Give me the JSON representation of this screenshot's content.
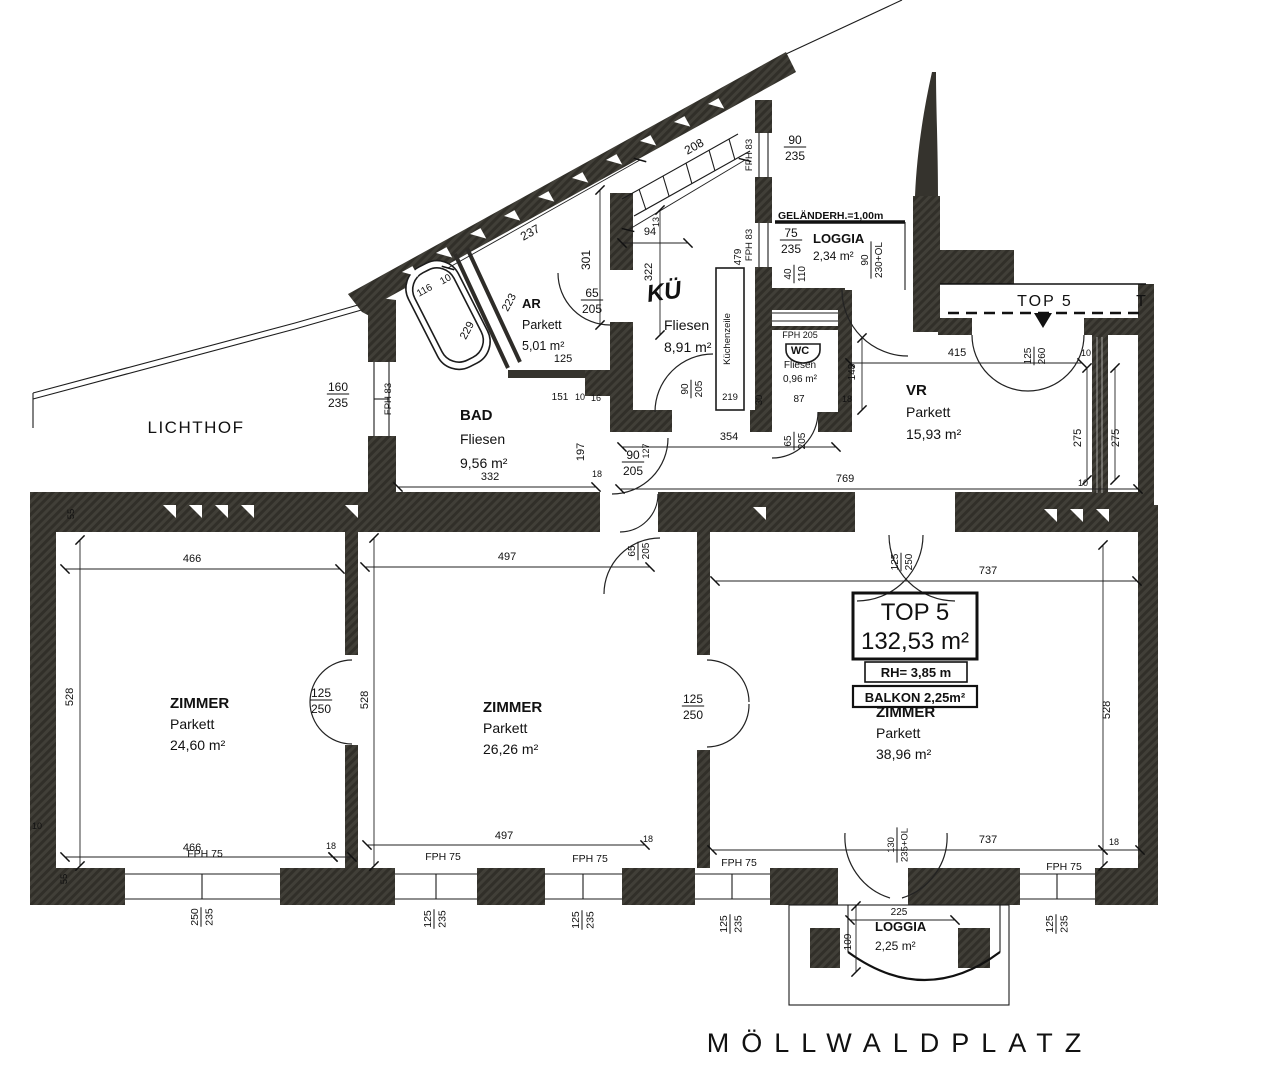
{
  "plan": {
    "street": "MÖLLWALDPLATZ",
    "courtyard": "LICHTHOF",
    "railing_note": "GELÄNDERH.=1,00m",
    "stairwell_strip": {
      "label": "TOP 5",
      "partial_label": "T"
    },
    "title_box": {
      "name": "TOP 5",
      "area": "132,53 m²",
      "room_height": "RH= 3,85 m",
      "balcony": "BALKON 2,25m²"
    },
    "rooms": [
      {
        "name": "AR",
        "floor": "Parkett",
        "area": "5,01 m²",
        "x": 522,
        "y": 308,
        "lh": 21,
        "a": "start",
        "ns": 13,
        "s": 12.5
      },
      {
        "name": "BAD",
        "floor": "Fliesen",
        "area": "9,56 m²",
        "x": 460,
        "y": 420,
        "lh": 24,
        "a": "start",
        "ns": 15,
        "s": 14
      },
      {
        "name": "KÜ",
        "floor": "Fliesen",
        "area": "8,91 m²",
        "x": 664,
        "y": 330,
        "lh": 22,
        "a": "start",
        "ns": 15,
        "s": 14,
        "script": 1,
        "nx": 648,
        "ny": 302
      },
      {
        "name": "WC",
        "floor": "Fliesen",
        "area": "0,96 m²",
        "x": 800,
        "y": 354,
        "lh": 14,
        "a": "middle",
        "ns": 11,
        "s": 10
      },
      {
        "name": "VR",
        "floor": "Parkett",
        "area": "15,93 m²",
        "x": 906,
        "y": 395,
        "lh": 22,
        "a": "start",
        "ns": 15,
        "s": 14
      },
      {
        "name": "LOGGIA",
        "floor": "",
        "area": "2,34 m²",
        "x": 813,
        "y": 243,
        "lh": 17,
        "a": "start",
        "ns": 13,
        "s": 12
      },
      {
        "name": "ZIMMER",
        "floor": "Parkett",
        "area": "24,60 m²",
        "x": 170,
        "y": 708,
        "lh": 21,
        "a": "start",
        "ns": 15,
        "s": 14
      },
      {
        "name": "ZIMMER",
        "floor": "Parkett",
        "area": "26,26 m²",
        "x": 483,
        "y": 712,
        "lh": 21,
        "a": "start",
        "ns": 15,
        "s": 14
      },
      {
        "name": "ZIMMER",
        "floor": "Parkett",
        "area": "38,96 m²",
        "x": 876,
        "y": 717,
        "lh": 21,
        "a": "start",
        "ns": 15,
        "s": 14
      },
      {
        "name": "LOGGIA",
        "floor": "",
        "area": "2,25 m²",
        "x": 875,
        "y": 931,
        "lh": 19,
        "a": "start",
        "ns": 13,
        "s": 12
      }
    ],
    "dims": [
      {
        "t": "208",
        "x": 696,
        "y": 150,
        "r": -29
      },
      {
        "t": "FPH 83",
        "x": 752,
        "y": 155,
        "r": -90,
        "s": 9.5
      },
      {
        "t": "90/235",
        "x": 795,
        "y": 147,
        "st": 1
      },
      {
        "t": "75/235",
        "x": 791,
        "y": 240,
        "st": 1
      },
      {
        "t": "40/110",
        "x": 794,
        "y": 274,
        "r": -90,
        "st": 1,
        "s": 10
      },
      {
        "t": "90/230+OL",
        "x": 871,
        "y": 260,
        "r": -90,
        "st": 1,
        "s": 10
      },
      {
        "t": "479",
        "x": 741,
        "y": 257,
        "r": -90,
        "s": 10
      },
      {
        "t": "FPH 83",
        "x": 752,
        "y": 245,
        "r": -90,
        "s": 9.5
      },
      {
        "t": "94",
        "x": 650,
        "y": 235,
        "s": 11
      },
      {
        "t": "13",
        "x": 659,
        "y": 222,
        "r": -90,
        "s": 9
      },
      {
        "t": "322",
        "x": 652,
        "y": 272,
        "r": -90,
        "s": 11
      },
      {
        "t": "237",
        "x": 532,
        "y": 236,
        "r": -29
      },
      {
        "t": "301",
        "x": 590,
        "y": 260,
        "r": -90
      },
      {
        "t": "116",
        "x": 426,
        "y": 293,
        "r": -29,
        "s": 10
      },
      {
        "t": "10",
        "x": 447,
        "y": 282,
        "r": -29,
        "s": 10
      },
      {
        "t": "229",
        "x": 470,
        "y": 332,
        "r": -62,
        "s": 11
      },
      {
        "t": "223",
        "x": 512,
        "y": 304,
        "r": -62,
        "s": 11
      },
      {
        "t": "65/205",
        "x": 592,
        "y": 300,
        "st": 1
      },
      {
        "t": "125",
        "x": 563,
        "y": 362,
        "s": 11
      },
      {
        "t": "151",
        "x": 560,
        "y": 400,
        "s": 10
      },
      {
        "t": "10",
        "x": 580,
        "y": 400,
        "s": 9
      },
      {
        "t": "16",
        "x": 596,
        "y": 401,
        "s": 9
      },
      {
        "t": "160/235",
        "x": 338,
        "y": 394,
        "st": 1
      },
      {
        "t": "FPH 83",
        "x": 391,
        "y": 399,
        "r": -90,
        "s": 9.5
      },
      {
        "t": "332",
        "x": 490,
        "y": 480,
        "s": 11
      },
      {
        "t": "197",
        "x": 584,
        "y": 452,
        "r": -90,
        "s": 11
      },
      {
        "t": "18",
        "x": 597,
        "y": 477,
        "s": 9
      },
      {
        "t": "90/205",
        "x": 633,
        "y": 462,
        "st": 1
      },
      {
        "t": "127",
        "x": 649,
        "y": 451,
        "r": -90,
        "s": 9
      },
      {
        "t": "354",
        "x": 729,
        "y": 440,
        "s": 11
      },
      {
        "t": "65/205",
        "x": 794,
        "y": 441,
        "r": -90,
        "st": 1,
        "s": 10
      },
      {
        "t": "769",
        "x": 845,
        "y": 482,
        "s": 11
      },
      {
        "t": "90/205",
        "x": 691,
        "y": 389,
        "r": -90,
        "st": 1,
        "s": 10
      },
      {
        "t": "219",
        "x": 730,
        "y": 400,
        "s": 9.5
      },
      {
        "t": "30",
        "x": 762,
        "y": 400,
        "r": -90,
        "s": 9.5
      },
      {
        "t": "87",
        "x": 799,
        "y": 402,
        "s": 10
      },
      {
        "t": "18",
        "x": 847,
        "y": 402,
        "s": 9
      },
      {
        "t": "148",
        "x": 855,
        "y": 372,
        "r": -90,
        "s": 10
      },
      {
        "t": "FPH 205",
        "x": 800,
        "y": 338,
        "s": 9
      },
      {
        "t": "415",
        "x": 957,
        "y": 356,
        "s": 11
      },
      {
        "t": "125/260",
        "x": 1034,
        "y": 356,
        "r": -90,
        "st": 1,
        "s": 10
      },
      {
        "t": "10",
        "x": 1086,
        "y": 356,
        "s": 9
      },
      {
        "t": "275",
        "x": 1081,
        "y": 438,
        "r": -90,
        "s": 11
      },
      {
        "t": "275",
        "x": 1119,
        "y": 438,
        "r": -90,
        "s": 11
      },
      {
        "t": "10",
        "x": 1083,
        "y": 486,
        "s": 9
      },
      {
        "t": "Küchenzeile",
        "x": 730,
        "y": 339,
        "r": -90,
        "s": 9.5
      },
      {
        "t": "55",
        "x": 74,
        "y": 514,
        "r": -90,
        "s": 9.5
      },
      {
        "t": "466",
        "x": 192,
        "y": 562,
        "s": 11
      },
      {
        "t": "497",
        "x": 507,
        "y": 560,
        "s": 11
      },
      {
        "t": "737",
        "x": 988,
        "y": 574,
        "s": 11
      },
      {
        "t": "65/205",
        "x": 638,
        "y": 551,
        "r": -90,
        "st": 1,
        "s": 10
      },
      {
        "t": "125/250",
        "x": 901,
        "y": 562,
        "r": -90,
        "st": 1,
        "s": 10
      },
      {
        "t": "528",
        "x": 73,
        "y": 697,
        "r": -90,
        "s": 11
      },
      {
        "t": "528",
        "x": 368,
        "y": 700,
        "r": -90,
        "s": 11
      },
      {
        "t": "528",
        "x": 1110,
        "y": 710,
        "r": -90,
        "s": 11
      },
      {
        "t": "125/250",
        "x": 321,
        "y": 700,
        "st": 1
      },
      {
        "t": "125/250",
        "x": 693,
        "y": 706,
        "st": 1
      },
      {
        "t": "466",
        "x": 192,
        "y": 851,
        "s": 11
      },
      {
        "t": "18",
        "x": 331,
        "y": 849,
        "s": 9
      },
      {
        "t": "497",
        "x": 504,
        "y": 839,
        "s": 11
      },
      {
        "t": "18",
        "x": 648,
        "y": 842,
        "s": 9
      },
      {
        "t": "737",
        "x": 988,
        "y": 843,
        "s": 11
      },
      {
        "t": "18",
        "x": 1114,
        "y": 845,
        "s": 9
      },
      {
        "t": "10",
        "x": 37,
        "y": 829,
        "s": 9
      },
      {
        "t": "55",
        "x": 67,
        "y": 879,
        "r": -90,
        "s": 9.5
      },
      {
        "t": "FPH 75",
        "x": 205,
        "y": 857,
        "s": 10.5
      },
      {
        "t": "FPH 75",
        "x": 443,
        "y": 860,
        "s": 10.5
      },
      {
        "t": "FPH 75",
        "x": 590,
        "y": 862,
        "s": 10.5
      },
      {
        "t": "FPH 75",
        "x": 739,
        "y": 866,
        "s": 10.5
      },
      {
        "t": "FPH 75",
        "x": 1064,
        "y": 870,
        "s": 10.5
      },
      {
        "t": "250/235",
        "x": 201,
        "y": 917,
        "r": -90,
        "st": 1,
        "s": 10.5
      },
      {
        "t": "125/235",
        "x": 434,
        "y": 919,
        "r": -90,
        "st": 1,
        "s": 10.5
      },
      {
        "t": "125/235",
        "x": 582,
        "y": 920,
        "r": -90,
        "st": 1,
        "s": 10.5
      },
      {
        "t": "125/235",
        "x": 730,
        "y": 924,
        "r": -90,
        "st": 1,
        "s": 10.5
      },
      {
        "t": "125/235",
        "x": 1056,
        "y": 924,
        "r": -90,
        "st": 1,
        "s": 10.5
      },
      {
        "t": "130/235+OL",
        "x": 897,
        "y": 845,
        "r": -90,
        "st": 1,
        "s": 9.5
      },
      {
        "t": "225",
        "x": 899,
        "y": 915,
        "s": 10
      },
      {
        "t": "109",
        "x": 851,
        "y": 942,
        "r": -90,
        "s": 10
      }
    ]
  }
}
